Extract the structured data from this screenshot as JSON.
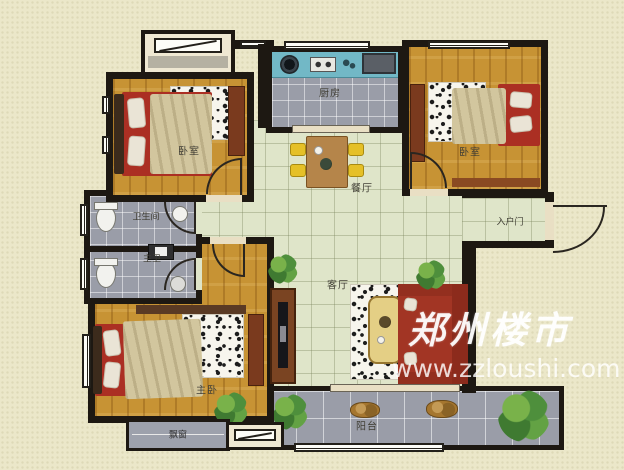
{
  "plan": {
    "rooms": [
      {
        "id": "bedroom-top-left",
        "label": "卧室"
      },
      {
        "id": "kitchen",
        "label": "厨房"
      },
      {
        "id": "bedroom-top-right",
        "label": "卧室"
      },
      {
        "id": "dining",
        "label": "餐厅"
      },
      {
        "id": "bathroom",
        "label": "卫生间"
      },
      {
        "id": "master-bath",
        "label": "主卫"
      },
      {
        "id": "entry",
        "label": "入户门"
      },
      {
        "id": "living",
        "label": "客厅"
      },
      {
        "id": "master-bedroom",
        "label": "主卧"
      },
      {
        "id": "balcony",
        "label": "阳台"
      },
      {
        "id": "bay-window",
        "label": "飘窗"
      }
    ]
  },
  "watermark": {
    "brand": "郑州楼市",
    "url": "www.zzloushi.com"
  },
  "colors": {
    "background": "#ebe7c9",
    "wall": "#1d1812",
    "wood": "#c79334",
    "tile_green": "#dfe5c9",
    "tile_gray": "#9a9da8",
    "counter_teal": "#72b8c6",
    "bed_red": "#ab2f23",
    "sofa_red": "#a23524",
    "furniture_brown": "#7a4422",
    "chair_yellow": "#e5c027",
    "plant_green": "#4e8f3c",
    "rug_white": "#f7f5ed"
  }
}
